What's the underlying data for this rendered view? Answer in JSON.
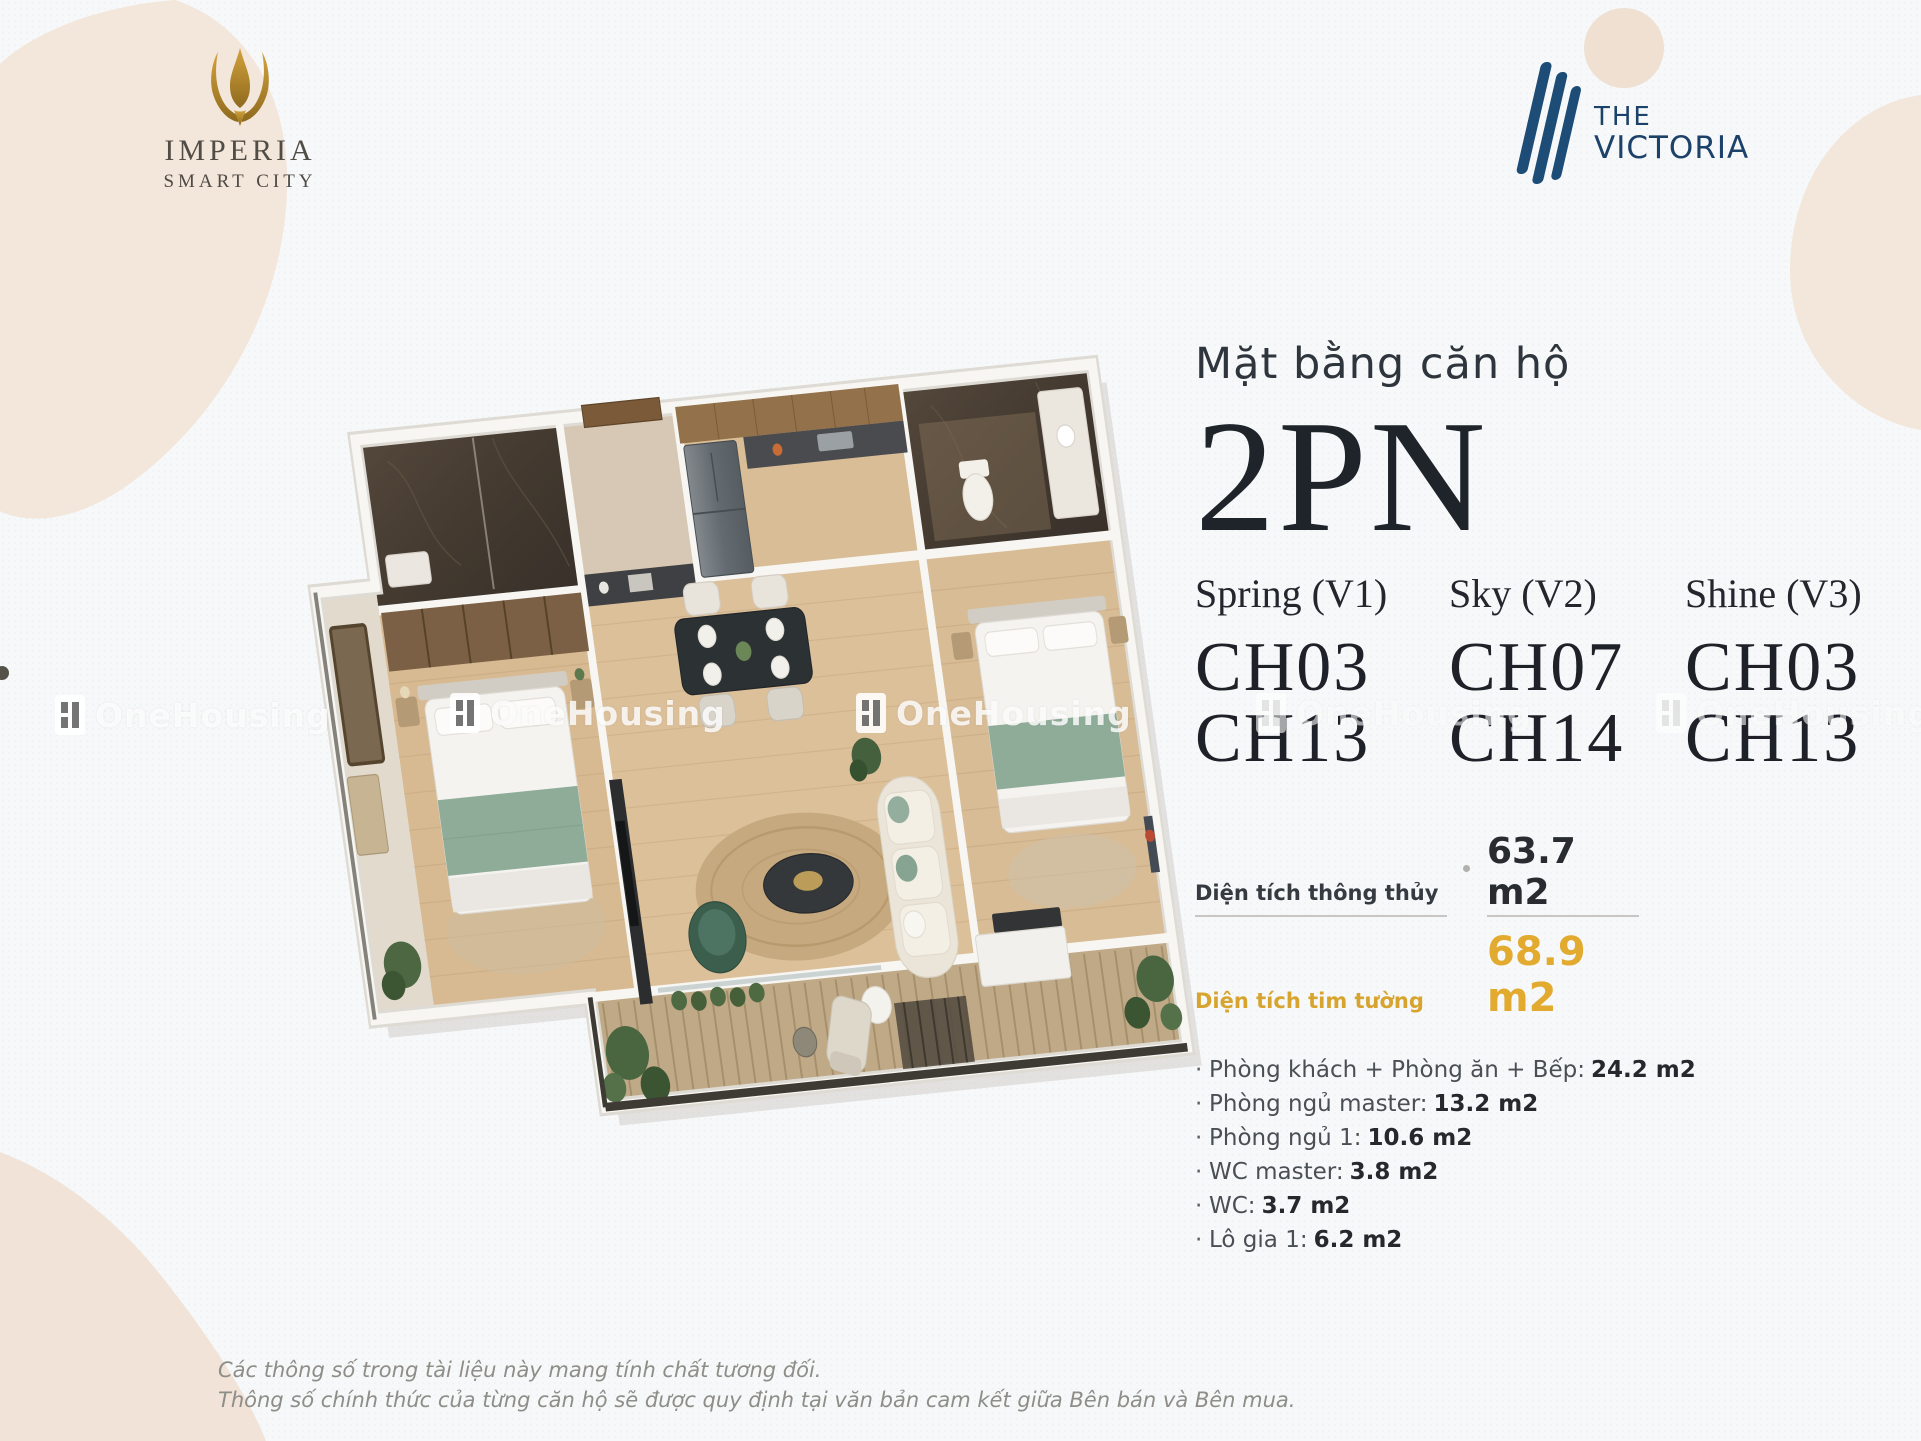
{
  "brand_left": {
    "name": "IMPERIA",
    "sub": "SMART CITY"
  },
  "brand_right": {
    "line1": "THE",
    "line2": "VICTORIA"
  },
  "watermark": {
    "text": "OneHousing"
  },
  "panel": {
    "subtitle": "Mặt bằng căn hộ",
    "title": "2PN",
    "variants": [
      {
        "name": "Spring (V1)",
        "units": [
          "CH03",
          "CH13"
        ]
      },
      {
        "name": "Sky (V2)",
        "units": [
          "CH07",
          "CH14"
        ]
      },
      {
        "name": "Shine (V3)",
        "units": [
          "CH03",
          "CH13"
        ]
      }
    ],
    "area_rows": [
      {
        "label": "Diện tích thông thủy",
        "value": "63.7 m2"
      },
      {
        "label": "Diện tích tim tường",
        "value": "68.9 m2"
      }
    ],
    "rooms": [
      {
        "label": "Phòng khách + Phòng ăn + Bếp:",
        "value": "24.2 m2"
      },
      {
        "label": "Phòng ngủ master:",
        "value": "13.2 m2"
      },
      {
        "label": "Phòng ngủ 1:",
        "value": "10.6 m2"
      },
      {
        "label": "WC master:",
        "value": "3.8 m2"
      },
      {
        "label": "WC:",
        "value": "3.7 m2"
      },
      {
        "label": "Lô gia 1:",
        "value": "6.2 m2"
      }
    ]
  },
  "disclaimer": {
    "line1": "Các thông số trong tài liệu này mang tính chất tương đối.",
    "line2": "Thông số chính thức của từng căn hộ sẽ được quy định tại văn bản cam kết giữa Bên bán và Bên mua."
  },
  "colors": {
    "gold_accent": "#e0a92f",
    "navy_brand": "#1d426a",
    "imperia_gold": "#b8862e",
    "blob_beige": "#f2e5d9",
    "text_dark": "#23272d",
    "text_gray": "#4a4f55",
    "disclaimer_gray": "#8f8d88"
  }
}
